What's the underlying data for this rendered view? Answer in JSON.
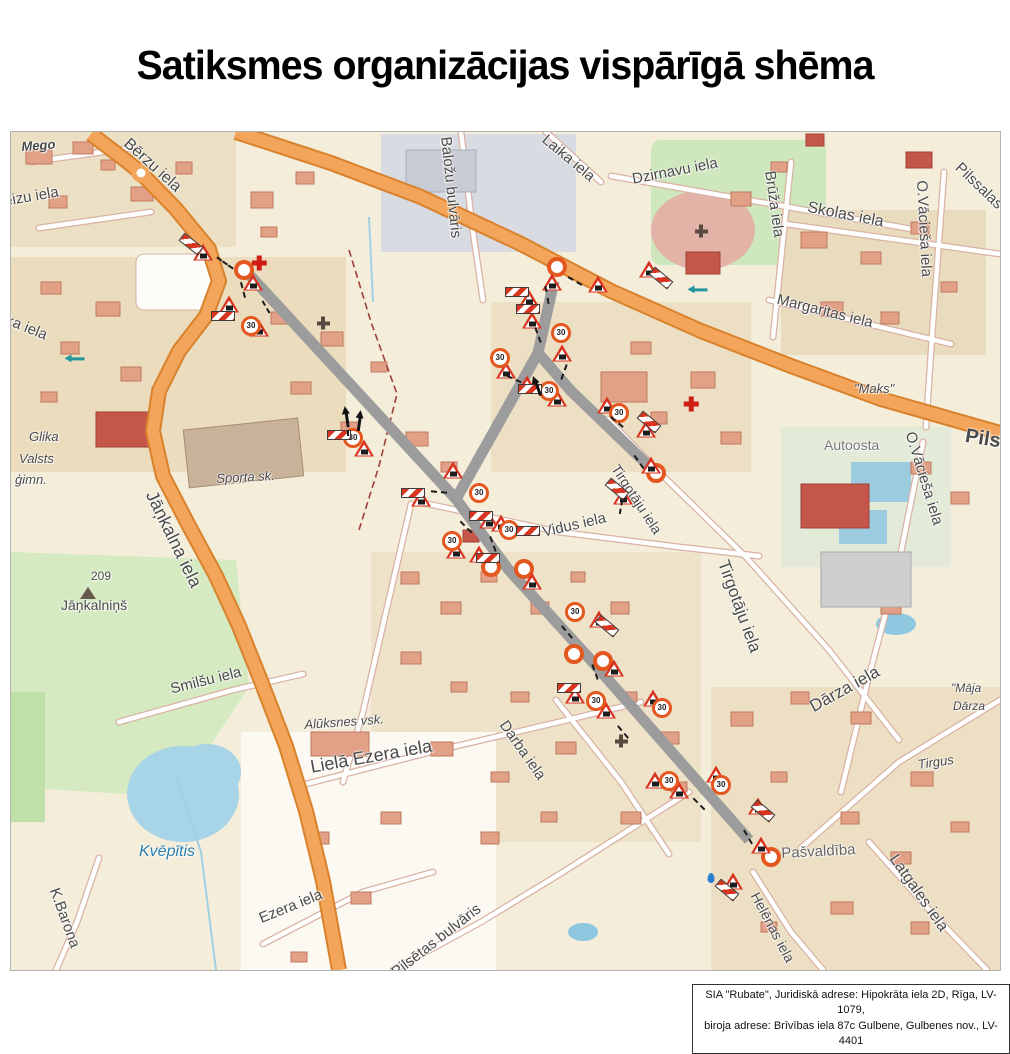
{
  "title": "Satiksmes organizācijas vispārīgā shēma",
  "footer": {
    "line1": "SIA \"Rubate\", Juridiskā adrese: Hipokrāta iela 2D, Rīga, LV-1079,",
    "line2": "biroja adrese: Brīvības iela 87c Gulbene, Gulbenes nov., LV-4401"
  },
  "map": {
    "colors": {
      "main_road": "#f2a55b",
      "main_road_casing": "#d9822b",
      "closed_route": "#9c9c9c",
      "sign_red": "#d8341f",
      "marker_orange": "#e4571e",
      "park_green": "#d5eac1",
      "water_blue": "#a7d4e6"
    },
    "sign_glyphs": {
      "limit": "30"
    },
    "symbols": {
      "M": "closure-endpoint-marker",
      "W": "road-works-warning-sign",
      "L": "speed-limit-30-sign",
      "B": "road-closed-barrier-sign",
      "A": "direction-arrow",
      "D": "leader-line",
      "CR": "pharmacy-cross",
      "CD": "church-cross",
      "T": "hill-summit-triangle",
      "ow": "one-way-arrow",
      "drop": "water-point"
    },
    "labels": [
      {
        "t": "Mego",
        "x": 10,
        "y": 8,
        "r": -4,
        "s": 13,
        "i": 1,
        "b": 1
      },
      {
        "t": "Bērzu iela",
        "x": 120,
        "y": 4,
        "r": 42,
        "s": 16
      },
      {
        "t": "ēizu iela",
        "x": -8,
        "y": 62,
        "r": -10,
        "s": 15
      },
      {
        "t": "lika iela",
        "x": -8,
        "y": 178,
        "r": 22,
        "s": 15
      },
      {
        "t": "Glika",
        "x": 18,
        "y": 298,
        "s": 13,
        "i": 1
      },
      {
        "t": "Valsts",
        "x": 8,
        "y": 320,
        "s": 13,
        "i": 1
      },
      {
        "t": "ģimn.",
        "x": 4,
        "y": 341,
        "s": 13,
        "i": 1
      },
      {
        "t": "Sporta sk.",
        "x": 205,
        "y": 340,
        "r": -3,
        "s": 13,
        "i": 1
      },
      {
        "t": "Jāņkalna iela",
        "x": 148,
        "y": 356,
        "r": 64,
        "s": 18
      },
      {
        "t": "209",
        "x": 80,
        "y": 438,
        "s": 12
      },
      {
        "t": "Jāņkalniņš",
        "x": 50,
        "y": 466,
        "s": 14
      },
      {
        "t": "Smilšu iela",
        "x": 158,
        "y": 550,
        "r": -14,
        "s": 15
      },
      {
        "t": "Kvēpītis",
        "x": 128,
        "y": 712,
        "s": 16,
        "i": 1,
        "c": "#2d7fae"
      },
      {
        "t": "K.Barona",
        "x": 50,
        "y": 754,
        "r": 70,
        "s": 15
      },
      {
        "t": "Alūksnes vsk.",
        "x": 293,
        "y": 586,
        "r": -4,
        "s": 13,
        "i": 1
      },
      {
        "t": "Lielā Ezera iela",
        "x": 298,
        "y": 626,
        "r": -10,
        "s": 18
      },
      {
        "t": "Darba iela",
        "x": 498,
        "y": 586,
        "r": 55,
        "s": 15
      },
      {
        "t": "Ezera iela",
        "x": 246,
        "y": 780,
        "r": -22,
        "s": 15
      },
      {
        "t": "Pilsētas bulvāris",
        "x": 378,
        "y": 836,
        "r": -38,
        "s": 15
      },
      {
        "t": "Baložu bulvāris",
        "x": 442,
        "y": 4,
        "r": 84,
        "s": 15
      },
      {
        "t": "Laika iela",
        "x": 538,
        "y": 0,
        "r": 40,
        "s": 15
      },
      {
        "t": "Dzirnavu iela",
        "x": 620,
        "y": 40,
        "r": -11,
        "s": 15
      },
      {
        "t": "Brūža iela",
        "x": 766,
        "y": 38,
        "r": 82,
        "s": 15
      },
      {
        "t": "Skolas iela",
        "x": 798,
        "y": 68,
        "r": 11,
        "s": 16
      },
      {
        "t": "Margaritas iela",
        "x": 768,
        "y": 160,
        "r": 14,
        "s": 15
      },
      {
        "t": "O.Vācieša iela",
        "x": 918,
        "y": 48,
        "r": 87,
        "s": 15
      },
      {
        "t": "Pilssalas iela",
        "x": 952,
        "y": 28,
        "r": 44,
        "s": 15
      },
      {
        "t": "\"Maks\"",
        "x": 843,
        "y": 250,
        "s": 13,
        "i": 1
      },
      {
        "t": "Pils iela",
        "x": 956,
        "y": 294,
        "r": 9,
        "s": 20,
        "b": 1
      },
      {
        "t": "Autoosta",
        "x": 813,
        "y": 306,
        "s": 14,
        "c": "#767676"
      },
      {
        "t": "Vidus iela",
        "x": 530,
        "y": 393,
        "r": -13,
        "s": 15
      },
      {
        "t": "Tirgotāju iela",
        "x": 610,
        "y": 330,
        "r": 57,
        "s": 14
      },
      {
        "t": "Tirgotāju iela",
        "x": 720,
        "y": 426,
        "r": 70,
        "s": 17
      },
      {
        "t": "O.Vācieša iela",
        "x": 906,
        "y": 298,
        "r": 73,
        "s": 15
      },
      {
        "t": "Dārza iela",
        "x": 796,
        "y": 568,
        "r": -29,
        "s": 17
      },
      {
        "t": "\"Māja",
        "x": 940,
        "y": 550,
        "s": 12,
        "i": 1
      },
      {
        "t": "Dārza",
        "x": 942,
        "y": 568,
        "s": 12,
        "i": 1
      },
      {
        "t": "Tirgus",
        "x": 906,
        "y": 626,
        "r": -8,
        "s": 13,
        "i": 1
      },
      {
        "t": "Pašvaldība",
        "x": 770,
        "y": 714,
        "r": -3,
        "s": 15,
        "c": "#666666"
      },
      {
        "t": "Helēnas iela",
        "x": 750,
        "y": 758,
        "r": 62,
        "s": 14
      },
      {
        "t": "Latgales iela",
        "x": 888,
        "y": 720,
        "r": 55,
        "s": 16
      }
    ],
    "signs": [
      {
        "k": "M",
        "x": 233,
        "y": 138
      },
      {
        "k": "M",
        "x": 546,
        "y": 135
      },
      {
        "k": "M",
        "x": 480,
        "y": 435
      },
      {
        "k": "M",
        "x": 513,
        "y": 437
      },
      {
        "k": "M",
        "x": 563,
        "y": 522
      },
      {
        "k": "M",
        "x": 592,
        "y": 529
      },
      {
        "k": "M",
        "x": 645,
        "y": 341
      },
      {
        "k": "M",
        "x": 760,
        "y": 725
      },
      {
        "k": "W",
        "x": 192,
        "y": 120
      },
      {
        "k": "W",
        "x": 242,
        "y": 150
      },
      {
        "k": "W",
        "x": 218,
        "y": 172
      },
      {
        "k": "W",
        "x": 248,
        "y": 196
      },
      {
        "k": "W",
        "x": 541,
        "y": 150
      },
      {
        "k": "W",
        "x": 587,
        "y": 152
      },
      {
        "k": "W",
        "x": 518,
        "y": 166
      },
      {
        "k": "W",
        "x": 521,
        "y": 188
      },
      {
        "k": "W",
        "x": 551,
        "y": 221
      },
      {
        "k": "W",
        "x": 495,
        "y": 238
      },
      {
        "k": "W",
        "x": 516,
        "y": 252
      },
      {
        "k": "W",
        "x": 546,
        "y": 266
      },
      {
        "k": "W",
        "x": 638,
        "y": 137
      },
      {
        "k": "W",
        "x": 596,
        "y": 273
      },
      {
        "k": "W",
        "x": 635,
        "y": 297
      },
      {
        "k": "W",
        "x": 640,
        "y": 333
      },
      {
        "k": "W",
        "x": 612,
        "y": 364
      },
      {
        "k": "W",
        "x": 410,
        "y": 366
      },
      {
        "k": "W",
        "x": 442,
        "y": 338
      },
      {
        "k": "W",
        "x": 478,
        "y": 388
      },
      {
        "k": "W",
        "x": 490,
        "y": 391
      },
      {
        "k": "W",
        "x": 445,
        "y": 418
      },
      {
        "k": "W",
        "x": 468,
        "y": 422
      },
      {
        "k": "W",
        "x": 521,
        "y": 449
      },
      {
        "k": "W",
        "x": 353,
        "y": 316
      },
      {
        "k": "W",
        "x": 588,
        "y": 487
      },
      {
        "k": "W",
        "x": 603,
        "y": 536
      },
      {
        "k": "W",
        "x": 564,
        "y": 563
      },
      {
        "k": "W",
        "x": 595,
        "y": 578
      },
      {
        "k": "W",
        "x": 642,
        "y": 566
      },
      {
        "k": "W",
        "x": 705,
        "y": 642
      },
      {
        "k": "W",
        "x": 668,
        "y": 658
      },
      {
        "k": "W",
        "x": 644,
        "y": 648
      },
      {
        "k": "W",
        "x": 747,
        "y": 674
      },
      {
        "k": "W",
        "x": 750,
        "y": 713
      },
      {
        "k": "W",
        "x": 722,
        "y": 749
      },
      {
        "k": "L",
        "x": 240,
        "y": 194
      },
      {
        "k": "L",
        "x": 550,
        "y": 201
      },
      {
        "k": "L",
        "x": 489,
        "y": 226
      },
      {
        "k": "L",
        "x": 538,
        "y": 259
      },
      {
        "k": "L",
        "x": 608,
        "y": 281
      },
      {
        "k": "L",
        "x": 468,
        "y": 361
      },
      {
        "k": "L",
        "x": 498,
        "y": 398
      },
      {
        "k": "L",
        "x": 441,
        "y": 409
      },
      {
        "k": "L",
        "x": 342,
        "y": 306
      },
      {
        "k": "L",
        "x": 564,
        "y": 480
      },
      {
        "k": "L",
        "x": 585,
        "y": 569
      },
      {
        "k": "L",
        "x": 651,
        "y": 576
      },
      {
        "k": "L",
        "x": 658,
        "y": 649
      },
      {
        "k": "L",
        "x": 710,
        "y": 653
      },
      {
        "k": "B",
        "x": 180,
        "y": 112,
        "r": 38
      },
      {
        "k": "B",
        "x": 212,
        "y": 184
      },
      {
        "k": "B",
        "x": 506,
        "y": 160
      },
      {
        "k": "B",
        "x": 517,
        "y": 177
      },
      {
        "k": "B",
        "x": 519,
        "y": 257
      },
      {
        "k": "B",
        "x": 650,
        "y": 146,
        "r": 40
      },
      {
        "k": "B",
        "x": 638,
        "y": 290,
        "r": 40
      },
      {
        "k": "B",
        "x": 606,
        "y": 357,
        "r": 40
      },
      {
        "k": "B",
        "x": 402,
        "y": 361
      },
      {
        "k": "B",
        "x": 470,
        "y": 384
      },
      {
        "k": "B",
        "x": 517,
        "y": 399
      },
      {
        "k": "B",
        "x": 477,
        "y": 426
      },
      {
        "k": "B",
        "x": 596,
        "y": 494,
        "r": 40
      },
      {
        "k": "B",
        "x": 558,
        "y": 556
      },
      {
        "k": "B",
        "x": 752,
        "y": 679,
        "r": 40
      },
      {
        "k": "B",
        "x": 716,
        "y": 758,
        "r": 40
      },
      {
        "k": "B",
        "x": 328,
        "y": 303
      },
      {
        "k": "A",
        "x": 527,
        "y": 257,
        "r": -20
      },
      {
        "k": "A",
        "x": 336,
        "y": 288,
        "r": -8
      },
      {
        "k": "A",
        "x": 348,
        "y": 292,
        "r": 8
      },
      {
        "k": "CR",
        "x": 248,
        "y": 131
      },
      {
        "k": "CR",
        "x": 680,
        "y": 272
      },
      {
        "k": "CD",
        "x": 690,
        "y": 99
      },
      {
        "k": "CD",
        "x": 610,
        "y": 609
      },
      {
        "k": "CD",
        "x": 312,
        "y": 191
      },
      {
        "k": "T",
        "x": 77,
        "y": 461
      },
      {
        "k": "ow",
        "x": 67,
        "y": 227
      },
      {
        "k": "ow",
        "x": 690,
        "y": 158
      },
      {
        "k": "drop",
        "x": 700,
        "y": 746
      },
      {
        "k": "D",
        "x": 214,
        "y": 131,
        "r": 35,
        "l": 20
      },
      {
        "k": "D",
        "x": 232,
        "y": 158,
        "r": 75,
        "l": 16
      },
      {
        "k": "D",
        "x": 536,
        "y": 163,
        "r": 80,
        "l": 18
      },
      {
        "k": "D",
        "x": 564,
        "y": 149,
        "r": 30,
        "l": 16
      },
      {
        "k": "D",
        "x": 527,
        "y": 203,
        "r": 70,
        "l": 16
      },
      {
        "k": "D",
        "x": 503,
        "y": 247,
        "r": 25,
        "l": 16
      },
      {
        "k": "D",
        "x": 553,
        "y": 240,
        "r": 110,
        "l": 16
      },
      {
        "k": "D",
        "x": 606,
        "y": 290,
        "r": 40,
        "l": 16
      },
      {
        "k": "D",
        "x": 628,
        "y": 330,
        "r": 55,
        "l": 16
      },
      {
        "k": "D",
        "x": 428,
        "y": 360,
        "r": 5,
        "l": 16
      },
      {
        "k": "D",
        "x": 455,
        "y": 395,
        "r": 45,
        "l": 16
      },
      {
        "k": "D",
        "x": 482,
        "y": 412,
        "r": 70,
        "l": 16
      },
      {
        "k": "D",
        "x": 556,
        "y": 500,
        "r": 50,
        "l": 16
      },
      {
        "k": "D",
        "x": 584,
        "y": 540,
        "r": 70,
        "l": 16
      },
      {
        "k": "D",
        "x": 612,
        "y": 600,
        "r": 50,
        "l": 16
      },
      {
        "k": "D",
        "x": 688,
        "y": 672,
        "r": 45,
        "l": 16
      },
      {
        "k": "D",
        "x": 737,
        "y": 705,
        "r": 60,
        "l": 16
      },
      {
        "k": "D",
        "x": 337,
        "y": 297,
        "r": 90,
        "l": 14
      },
      {
        "k": "D",
        "x": 255,
        "y": 175,
        "r": 60,
        "l": 14
      },
      {
        "k": "D",
        "x": 610,
        "y": 375,
        "r": 100,
        "l": 14
      }
    ]
  }
}
